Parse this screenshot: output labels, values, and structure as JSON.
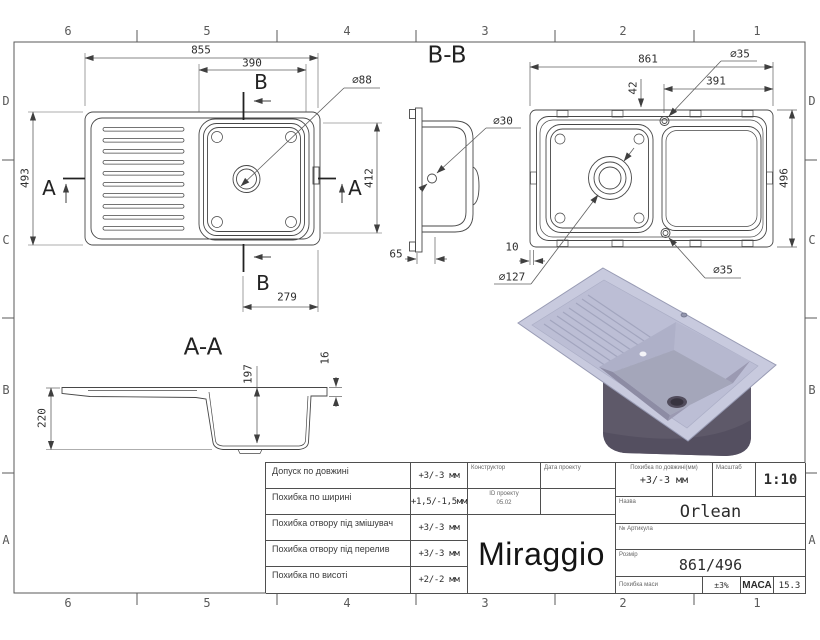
{
  "zones": {
    "top": [
      "6",
      "5",
      "4",
      "3",
      "2",
      "1"
    ],
    "bottom": [
      "6",
      "5",
      "4",
      "3",
      "2",
      "1"
    ],
    "left": [
      "D",
      "C",
      "B",
      "A"
    ],
    "right": [
      "D",
      "C",
      "B",
      "A"
    ]
  },
  "views": {
    "top_view": {
      "dim_width": "855",
      "dim_bowl_width": "390",
      "dim_height": "493",
      "dim_bowl_height": "412",
      "dim_bottom": "279",
      "callout_drain": "⌀88",
      "marker_a_left": "A",
      "marker_a_right": "A",
      "marker_b_top": "B",
      "marker_b_bottom": "B"
    },
    "section_bb": {
      "title": "B-B",
      "callout_hole": "⌀30",
      "dim_depth": "65"
    },
    "bottom_view": {
      "dim_width": "861",
      "dim_offset": "42",
      "dim_right": "391",
      "dim_height": "496",
      "dim_clip": "10",
      "callout_drain": "⌀127",
      "callout_hole_top": "⌀35",
      "callout_hole_bottom": "⌀35"
    },
    "section_aa": {
      "title": "A-A",
      "dim_total_height": "220",
      "dim_bowl_depth": "197",
      "dim_rim": "16"
    }
  },
  "title_block": {
    "tolerances": [
      {
        "label": "Допуск по довжині",
        "value": "+3/-3 мм"
      },
      {
        "label": "Похибка по ширині",
        "value": "+1,5/-1,5мм"
      },
      {
        "label": "Похибка отвору під змішувач",
        "value": "+3/-3 мм"
      },
      {
        "label": "Похибка отвору під перелив",
        "value": "+3/-3 мм"
      },
      {
        "label": "Похибка по висоті",
        "value": "+2/-2 мм"
      }
    ],
    "constructor_label": "Конструктор",
    "project_date_label": "Дата проекту",
    "project_id_label": "ID проекту",
    "project_id_value": "05.02",
    "logo": "Miraggio",
    "length_tol_label": "Похибка по довжині(мм)",
    "length_tol_value": "+3/-3 мм",
    "scale_label": "Масштаб",
    "scale_value": "1:10",
    "name_label": "Назва",
    "name_value": "Orlean",
    "article_label": "№ Артикула",
    "size_label": "Розмір",
    "size_value": "861/496",
    "mass_tol_label": "Похибка маси",
    "mass_tol_value": "±3%",
    "mass_label": "МАСА",
    "mass_value": "15.3"
  }
}
